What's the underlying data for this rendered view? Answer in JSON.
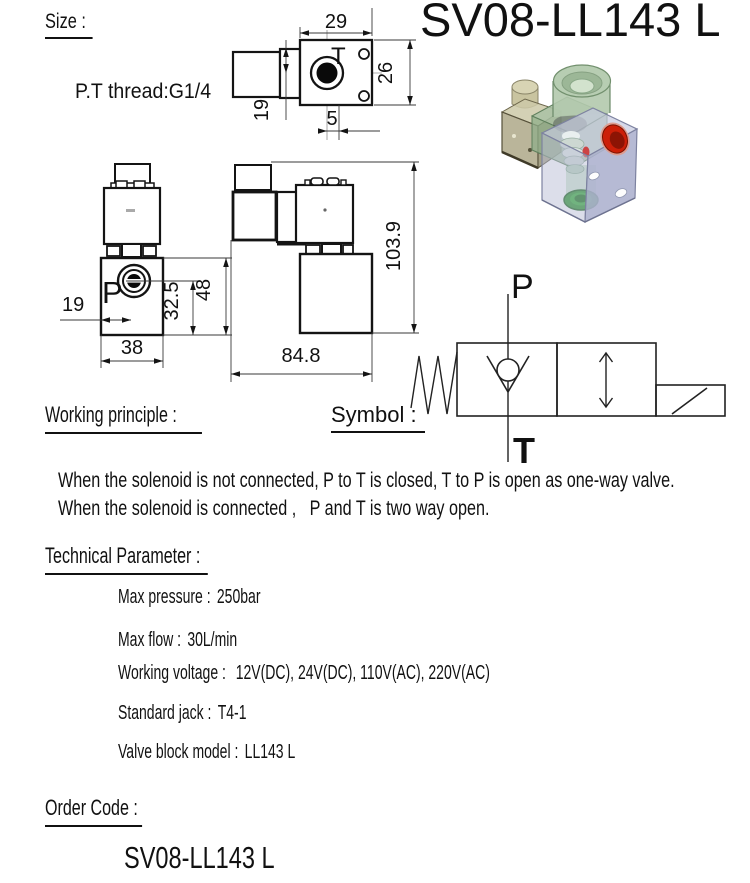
{
  "header": {
    "size_label": "Size :",
    "title": "SV08-LL143 L",
    "thread_note": "P.T thread:G1/4"
  },
  "top_view": {
    "dim_top": "29",
    "dim_right": "26",
    "dim_left": "19",
    "dim_bottom": "5",
    "port_label": "T"
  },
  "front_view": {
    "dim_left": "19",
    "dim_center": "32.5",
    "dim_right": "48",
    "dim_bottom": "38",
    "port_label": "P"
  },
  "side_view": {
    "dim_right": "103.9",
    "dim_bottom": "84.8"
  },
  "symbol": {
    "label": "Symbol :",
    "port_top": "P",
    "port_bottom": "T"
  },
  "working_principle": {
    "label": "Working principle :",
    "line1": "When the solenoid is not connected, P to T is closed, T to P is open as one-way valve.",
    "line2": "When the solenoid is connected ,   P and T is two way open."
  },
  "technical": {
    "label": "Technical Parameter :",
    "rows": [
      {
        "label": "Max pressure :",
        "value": "250bar"
      },
      {
        "label": "Max flow :",
        "value": "30L/min"
      },
      {
        "label": "Working voltage :",
        "value": "12V(DC), 24V(DC), 110V(AC), 220V(AC)"
      },
      {
        "label": "Standard jack :",
        "value": "T4-1"
      },
      {
        "label": "Valve block model :",
        "value": "LL143 L"
      }
    ]
  },
  "order": {
    "label": "Order Code :",
    "code": "SV08-LL143 L"
  },
  "colors": {
    "port_p_label": "#dd0000",
    "port_t_label": "#8080e8",
    "body_3d": "#bdc1d8",
    "coil_3d": "#b2c9ad",
    "connector_3d": "#b3ac88",
    "port_red": "#cc1f08",
    "port_green": "#1f8f1f"
  }
}
